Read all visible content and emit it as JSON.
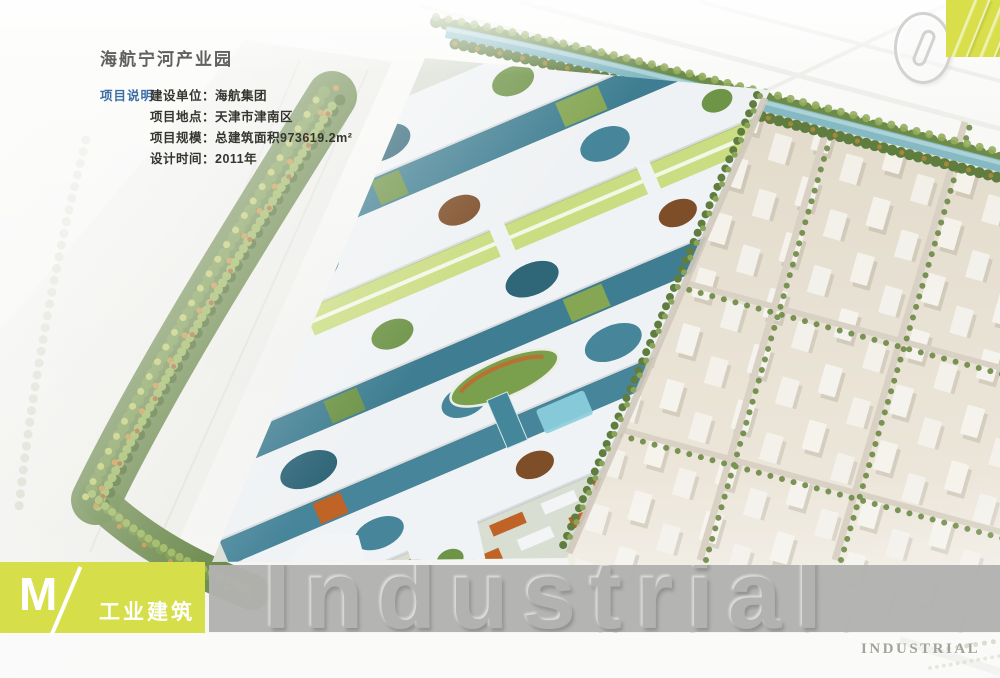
{
  "header": {
    "title": "海航宁河产业园"
  },
  "project": {
    "label": "项目说明",
    "lines": [
      "建设单位：海航集团",
      "项目地点：天津市津南区",
      "项目规模：总建筑面积973619.2m²",
      "设计时间：2011年"
    ]
  },
  "corner": {
    "number": "01"
  },
  "footer": {
    "index_letter": "M",
    "category": "工业建筑",
    "banner_word": "Industrial",
    "watermark": "INDUSTRIAL"
  },
  "colors": {
    "accent_chartreuse": "#d8df4a",
    "banner_gray": "#b2b2b0",
    "label_blue": "#3e6da6",
    "title_gray": "#60605d"
  }
}
